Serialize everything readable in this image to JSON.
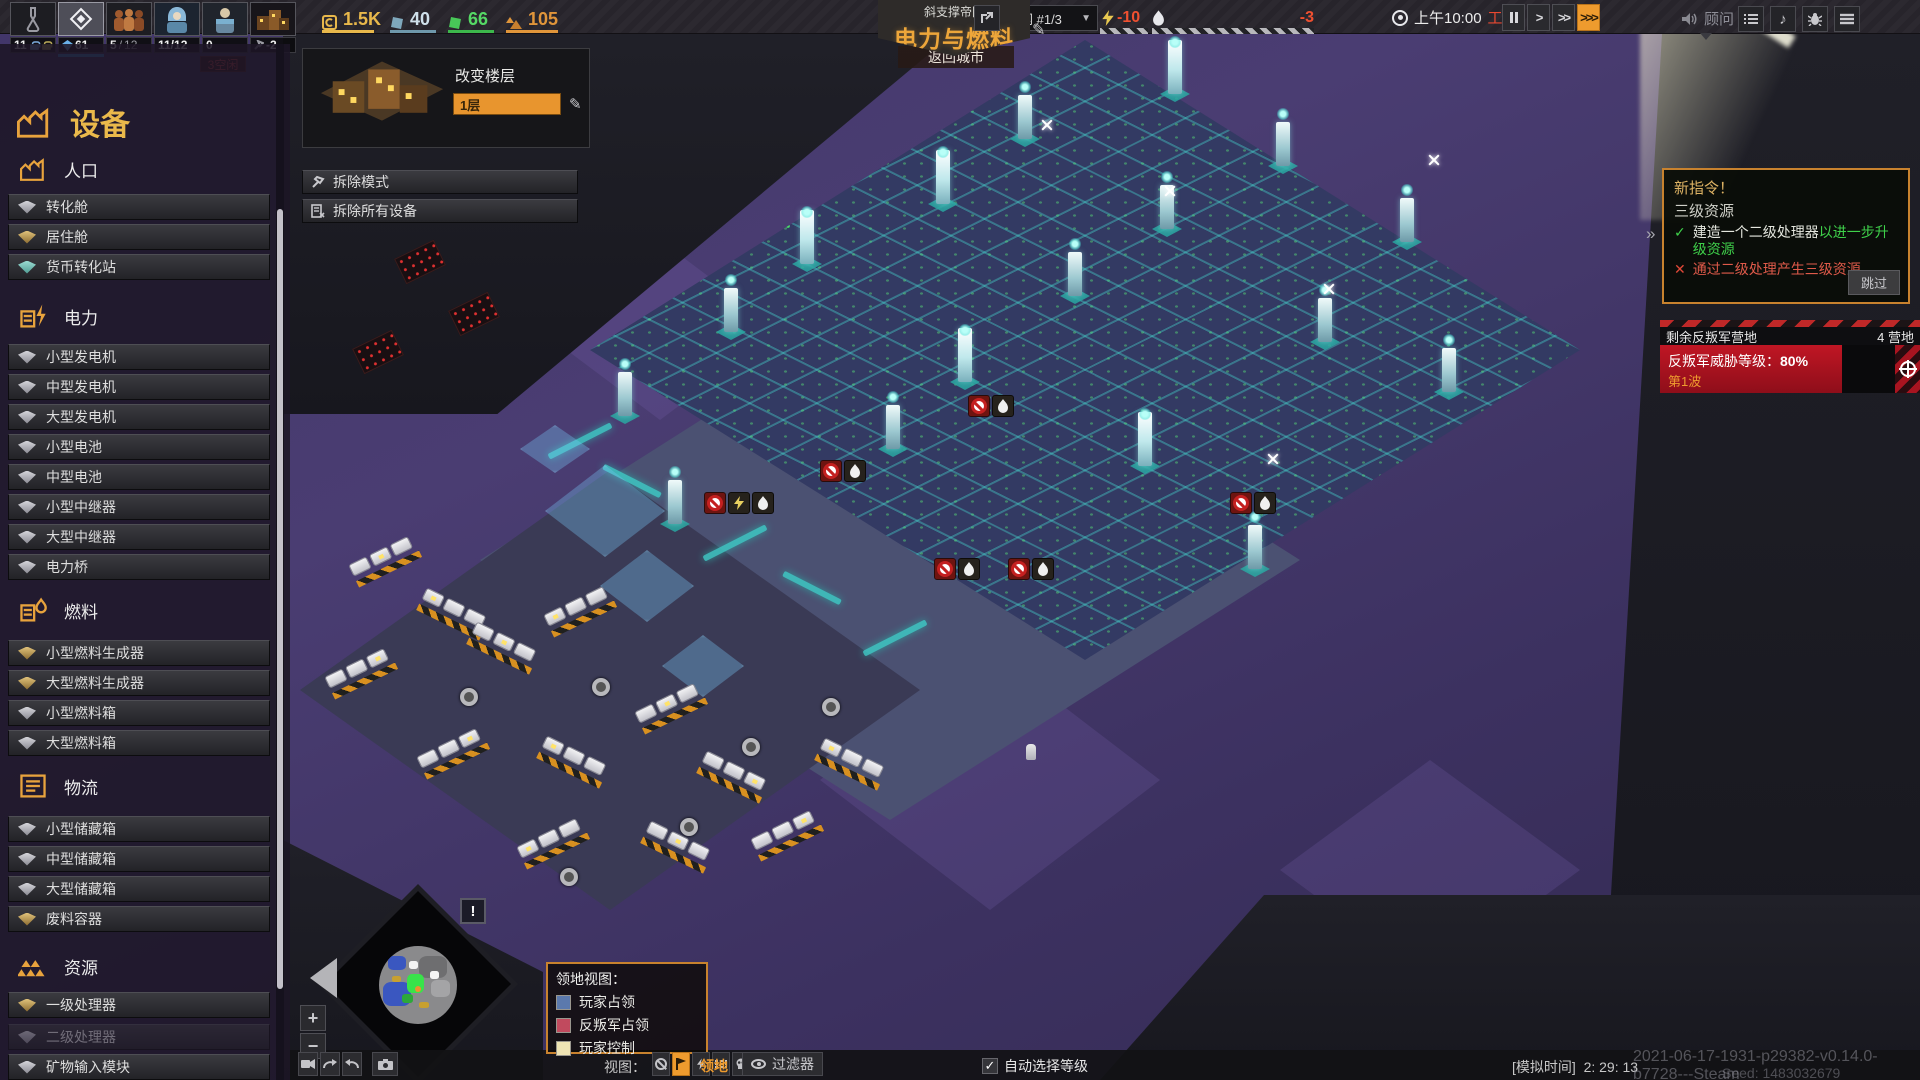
{
  "status_slots": {
    "research": {
      "value": "11"
    },
    "reactor": {
      "value": "61"
    },
    "population": {
      "current": "5",
      "max": "12"
    },
    "housing": {
      "value": "11/12",
      "badge": "3空闲"
    },
    "specialists": {
      "value": "0"
    },
    "factory": {
      "value": "-2"
    }
  },
  "resources": {
    "coins": "1.5K",
    "blue_crystal": "40",
    "green_crystal": "66",
    "minerals": "105"
  },
  "header": {
    "empire": "斜支撑帝国",
    "city_name": "电力与燃料",
    "back_button": "返回城市",
    "grid_label": "电网 #1/3",
    "power_value": "-10",
    "fuel_value": "-3",
    "time": "上午10:00",
    "shift": "工作",
    "advisor": "顾问"
  },
  "floor_panel": {
    "title": "改变楼层",
    "value": "1层"
  },
  "demolish": {
    "mode": "拆除模式",
    "all": "拆除所有设备"
  },
  "sidebar": {
    "title": "设备",
    "sections": [
      {
        "label": "人口",
        "items": [
          {
            "label": "转化舱"
          },
          {
            "label": "居住舱"
          },
          {
            "label": "货币转化站"
          }
        ]
      },
      {
        "label": "电力",
        "items": [
          {
            "label": "小型发电机"
          },
          {
            "label": "中型发电机"
          },
          {
            "label": "大型发电机"
          },
          {
            "label": "小型电池"
          },
          {
            "label": "中型电池"
          },
          {
            "label": "小型中继器"
          },
          {
            "label": "大型中继器"
          },
          {
            "label": "电力桥"
          }
        ]
      },
      {
        "label": "燃料",
        "items": [
          {
            "label": "小型燃料生成器"
          },
          {
            "label": "大型燃料生成器"
          },
          {
            "label": "小型燃料箱"
          },
          {
            "label": "大型燃料箱"
          }
        ]
      },
      {
        "label": "物流",
        "items": [
          {
            "label": "小型储藏箱"
          },
          {
            "label": "中型储藏箱"
          },
          {
            "label": "大型储藏箱"
          },
          {
            "label": "废料容器"
          }
        ]
      },
      {
        "label": "资源",
        "items": [
          {
            "label": "一级处理器"
          },
          {
            "label": "二级处理器",
            "disabled": true
          },
          {
            "label": "矿物输入模块"
          },
          {
            "label": "同位素输入模块",
            "disabled": true
          }
        ]
      }
    ]
  },
  "directive": {
    "header": "新指令！",
    "subject": "三级资源",
    "task1_main": "建造一个二级处理器",
    "task1_suffix": "以进一步升级资源",
    "task2": "通过二级处理产生三级资源",
    "skip": "跳过",
    "expand": "»"
  },
  "rebels": {
    "title": "剩余反叛军营地",
    "camps": "4 营地",
    "threat_label": "反叛军威胁等级：",
    "threat_value": "80%",
    "wave": "第1波",
    "progress_percent": 80
  },
  "legend": {
    "title": "领地视图：",
    "player_claim": "玩家占领",
    "rebel_claim": "反叛军占领",
    "player_control": "玩家控制",
    "colors": {
      "player_claim": "#5b79ad",
      "rebel_claim": "#c14a5e",
      "player_control": "#efe4b4"
    }
  },
  "bottom_bar": {
    "view_label": "视图：",
    "territory": "领地",
    "filter": "过滤器",
    "auto_select": "自动选择等级",
    "sim_label": "[模拟时间]",
    "sim_time": "2: 29: 13",
    "build": "2021-06-17-1931-p29382-v0.14.0-b7728---Steam",
    "seed": "Seed: 1483032679",
    "alert": "!"
  }
}
